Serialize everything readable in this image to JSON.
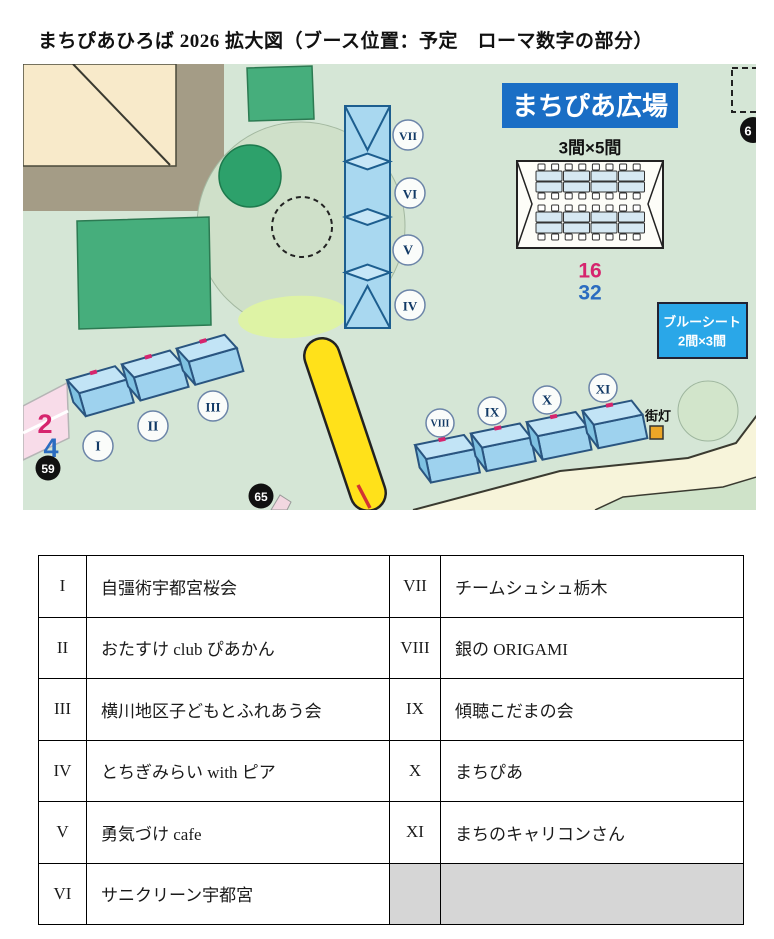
{
  "title": "まちぴあひろば 2026 拡大図（ブース位置：予定　ローマ数字の部分）",
  "map": {
    "plaza_banner": "まちぴあ広場",
    "tent_size_label": "3間×5間",
    "count_pink": "16",
    "count_blue": "32",
    "bluesheet": {
      "line1": "ブルーシート",
      "line2": "2間×3間"
    },
    "streetlamp_label": "街灯",
    "markers": {
      "m59": "59",
      "m65": "65",
      "m6": "6"
    },
    "pink_lane": {
      "top": "2",
      "bottom": "4"
    },
    "column_booths": [
      "VII",
      "VI",
      "V",
      "IV"
    ],
    "left_booths": [
      "I",
      "II",
      "III"
    ],
    "right_booths": [
      "VIII",
      "IX",
      "X",
      "XI"
    ],
    "colors": {
      "booth_blue": "#c2e4f6",
      "banner_blue": "#1a6ec5",
      "bluesheet_blue": "#2aa7e8",
      "accent_pink": "#d6256e",
      "accent_blue": "#2b6cc0",
      "lamp_orange": "#eda627"
    }
  },
  "table": {
    "rows": [
      {
        "num_l": "I",
        "name_l": "自彊術宇都宮桜会",
        "num_r": "VII",
        "name_r": "チームシュシュ栃木"
      },
      {
        "num_l": "II",
        "name_l": "おたすけ club ぴあかん",
        "num_r": "VIII",
        "name_r": "銀の ORIGAMI"
      },
      {
        "num_l": "III",
        "name_l": "横川地区子どもとふれあう会",
        "num_r": "IX",
        "name_r": "傾聴こだまの会"
      },
      {
        "num_l": "IV",
        "name_l": "とちぎみらい with ピア",
        "num_r": "X",
        "name_r": "まちぴあ"
      },
      {
        "num_l": "V",
        "name_l": "勇気づけ cafe",
        "num_r": "XI",
        "name_r": "まちのキャリコンさん"
      },
      {
        "num_l": "VI",
        "name_l": "サニクリーン宇都宮",
        "num_r": "",
        "name_r": ""
      }
    ]
  }
}
